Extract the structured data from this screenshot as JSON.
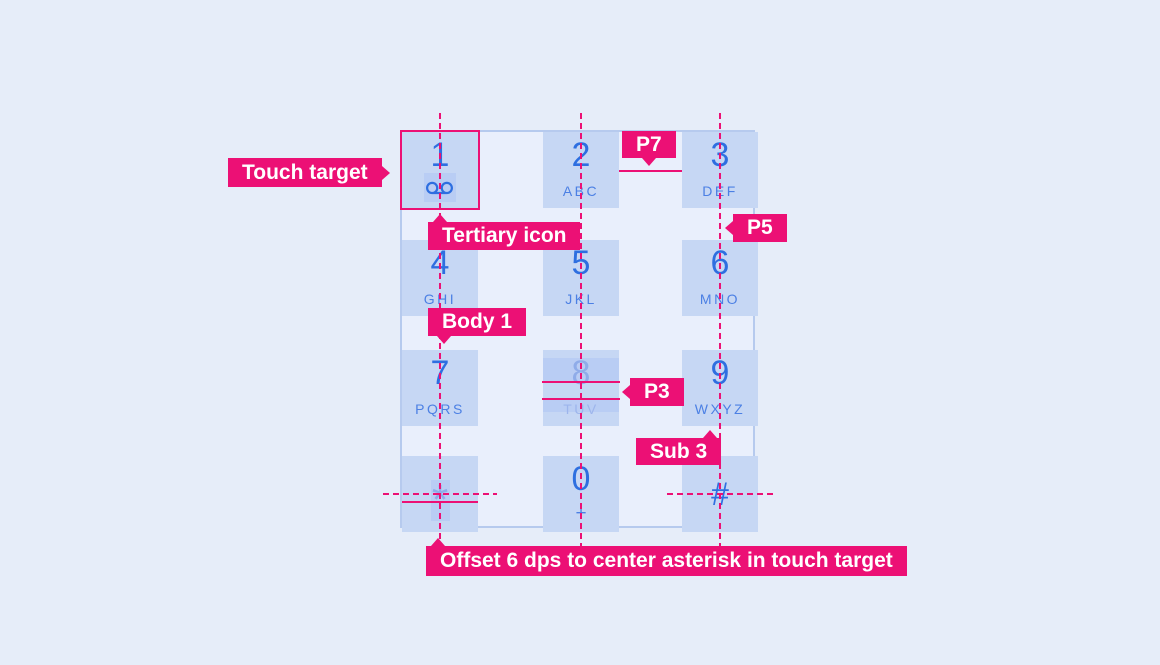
{
  "annotations": {
    "touch_target": "Touch target",
    "tertiary_icon": "Tertiary icon",
    "p7": "P7",
    "p5": "P5",
    "body1": "Body 1",
    "p3": "P3",
    "sub3": "Sub 3",
    "offset_note": "Offset 6 dps to center asterisk in touch target"
  },
  "keypad": {
    "keys": [
      {
        "id": "1",
        "digit": "1",
        "sub": "",
        "icon": "voicemail-icon"
      },
      {
        "id": "2",
        "digit": "2",
        "sub": "ABC"
      },
      {
        "id": "3",
        "digit": "3",
        "sub": "DEF"
      },
      {
        "id": "4",
        "digit": "4",
        "sub": "GHI"
      },
      {
        "id": "5",
        "digit": "5",
        "sub": "JKL"
      },
      {
        "id": "6",
        "digit": "6",
        "sub": "MNO"
      },
      {
        "id": "7",
        "digit": "7",
        "sub": "PQRS"
      },
      {
        "id": "8",
        "digit": "8",
        "sub": "TUV"
      },
      {
        "id": "9",
        "digit": "9",
        "sub": "WXYZ"
      },
      {
        "id": "star",
        "digit": "*",
        "sub": ""
      },
      {
        "id": "0",
        "digit": "0",
        "sub": "+"
      },
      {
        "id": "hash",
        "digit": "#",
        "sub": ""
      }
    ]
  },
  "colors": {
    "accent_pink": "#EC1075",
    "digit_blue": "#2E6FE0",
    "letter_blue": "#4C80E4",
    "key_fill": "#C6D7F4",
    "key_highlight": "#B9CDF4",
    "faded_blue": "#8FACE9",
    "page_background": "#E6EDF9",
    "panel_background": "#E9EFFC",
    "panel_border": "#B6CAEE"
  }
}
